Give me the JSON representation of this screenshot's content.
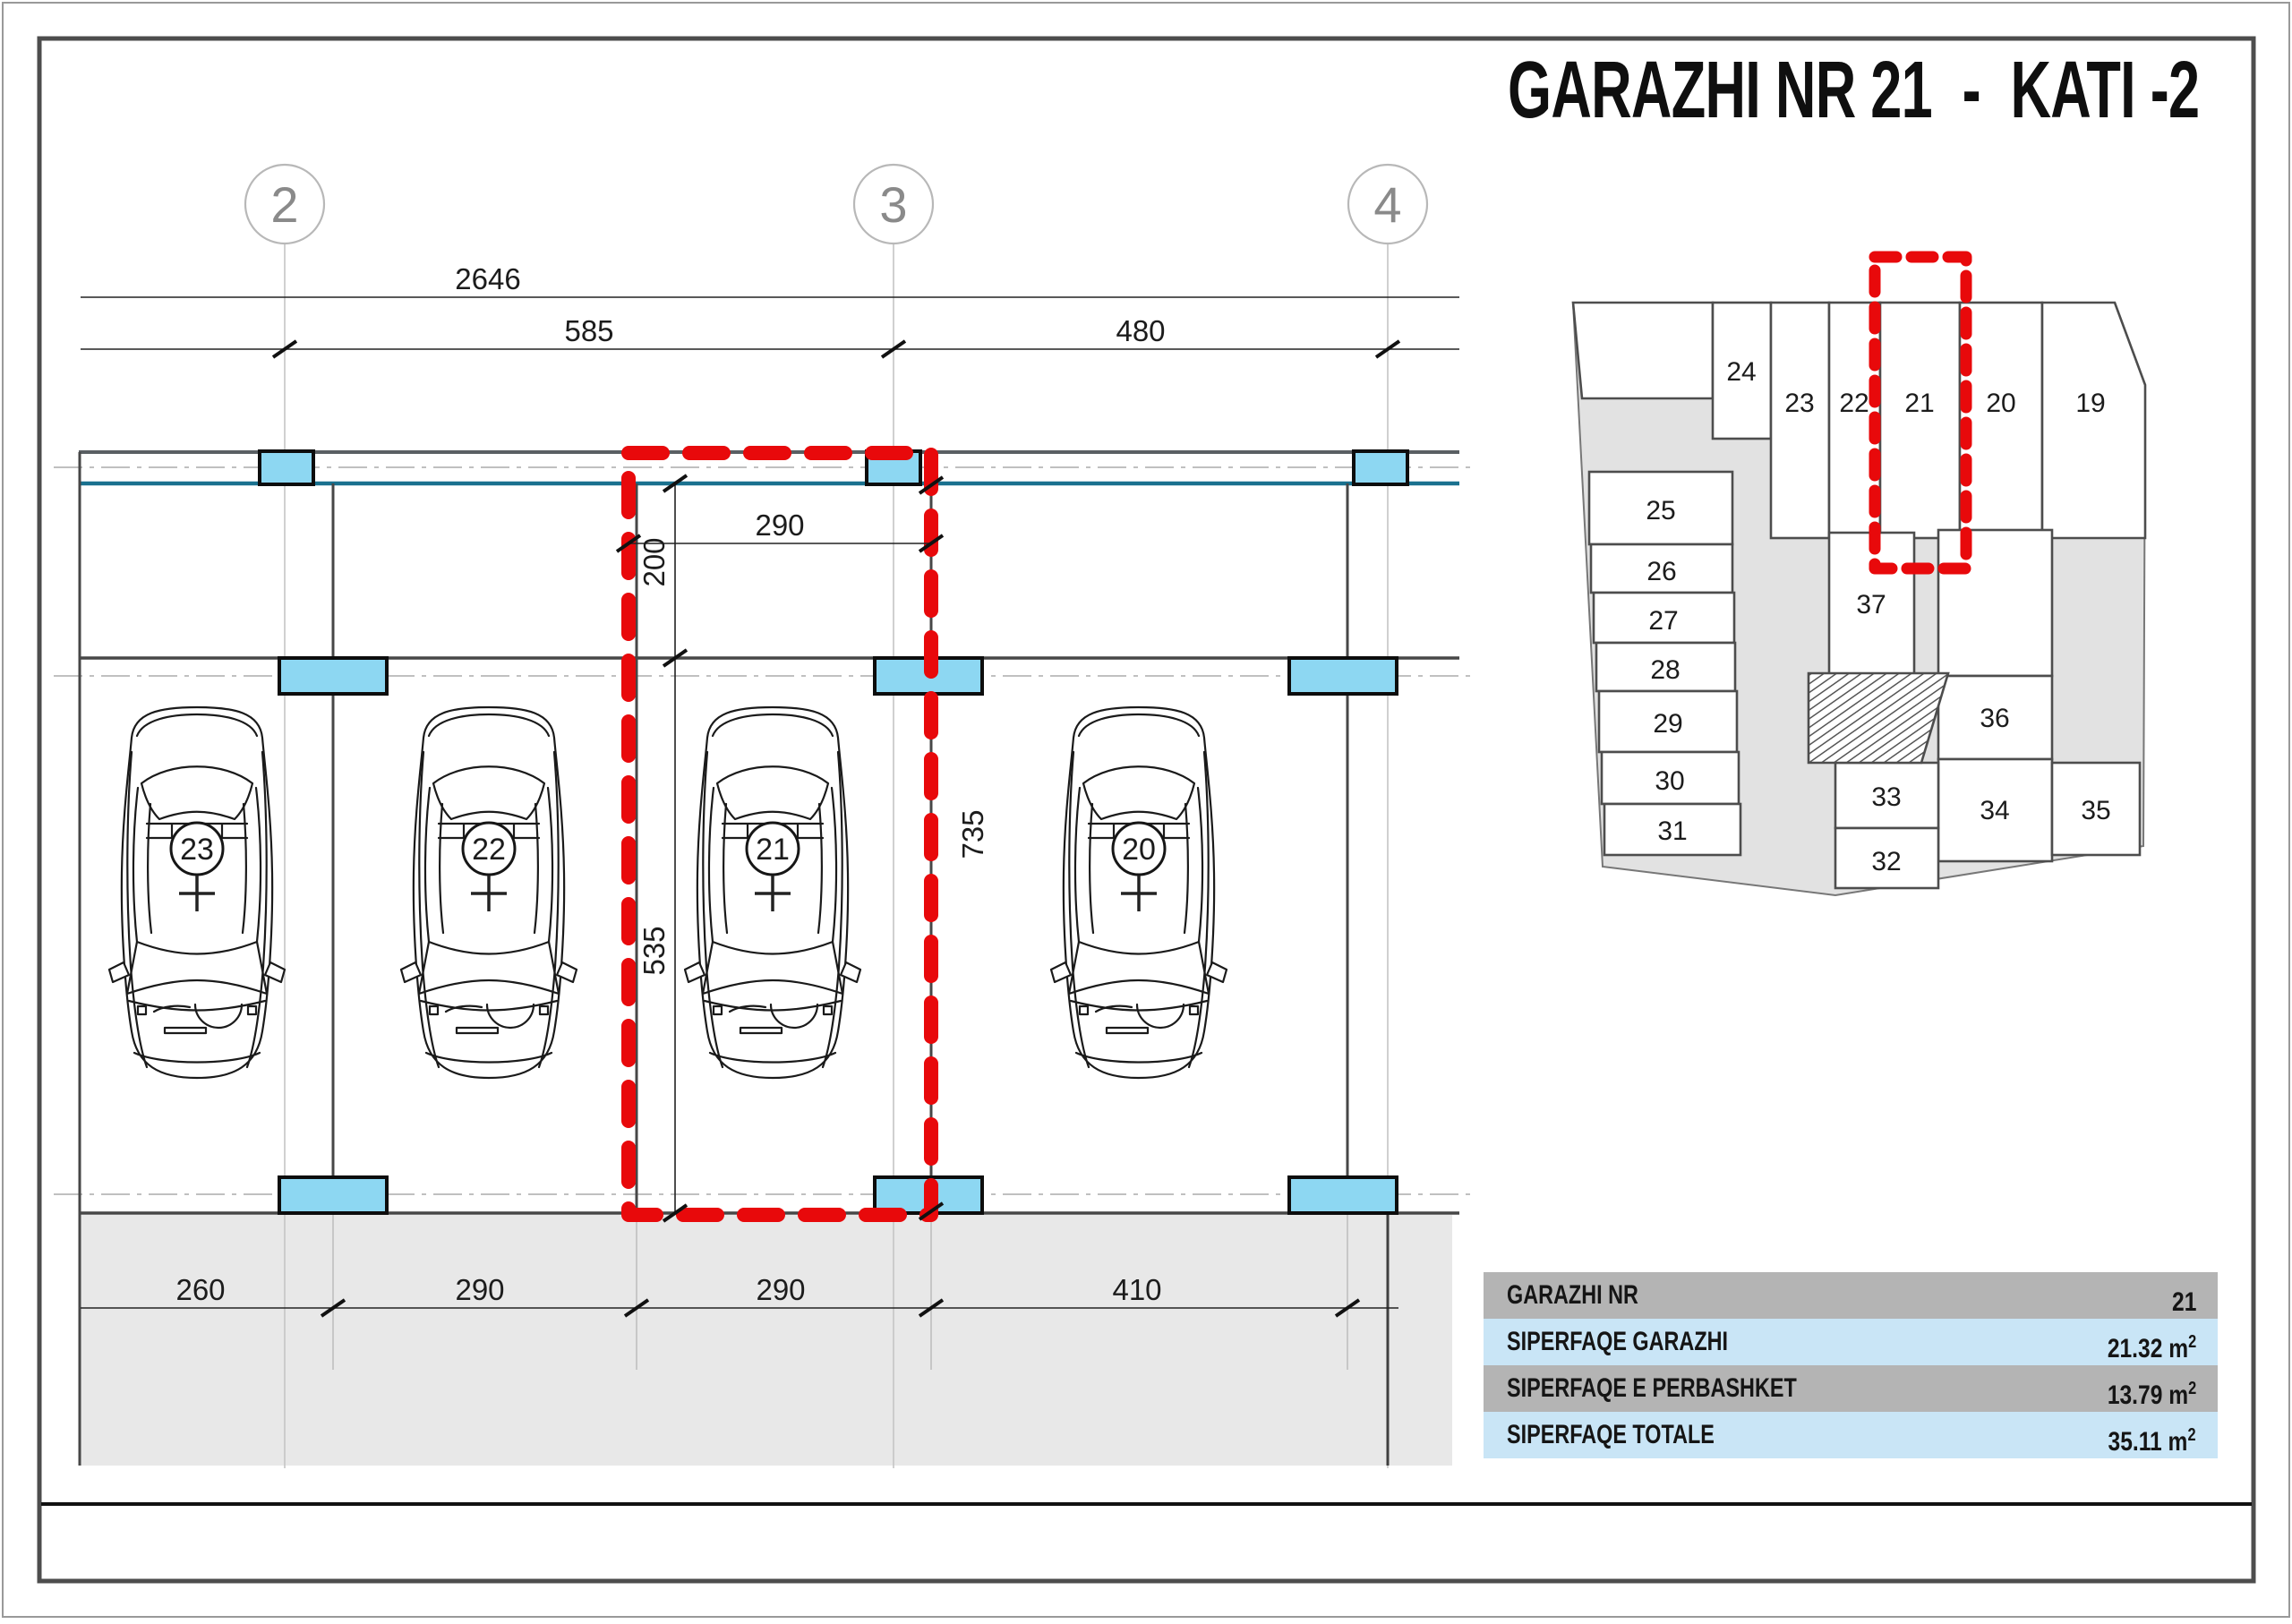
{
  "title": {
    "text": "GARAZHI NR 21  -  KATI -2"
  },
  "colors": {
    "accent_red": "#E8090B",
    "column_fill": "#8DD7F2",
    "wall_teal": "#19718F",
    "wall_slate": "#5A5F63",
    "driveway_gray": "#E8E8E8",
    "minimap_gray": "#E2E2E2",
    "table_row_gray": "#B4B4B4",
    "table_row_blue": "#C9E5F6"
  },
  "plan": {
    "grid_bubbles": [
      "2",
      "3",
      "4"
    ],
    "dims": {
      "overall": "2646",
      "left_span": "585",
      "right_span": "480",
      "garage_width": "290",
      "depth_upper": "200",
      "depth_lower": "535",
      "depth_total": "735",
      "bottom": [
        "260",
        "290",
        "290",
        "410"
      ]
    },
    "spaces": {
      "s23": "23",
      "s22": "22",
      "s21": "21",
      "s20": "20"
    }
  },
  "minimap": {
    "cells": {
      "c24": "24",
      "c23": "23",
      "c22": "22",
      "c21": "21",
      "c20": "20",
      "c19": "19",
      "c25": "25",
      "c26": "26",
      "c27": "27",
      "c28": "28",
      "c29": "29",
      "c30": "30",
      "c31": "31",
      "c37": "37",
      "c36": "36",
      "c33": "33",
      "c32": "32",
      "c34": "34",
      "c35": "35"
    },
    "highlighted_cell": "21"
  },
  "table": {
    "rows": [
      {
        "label": "GARAZHI NR",
        "value": "21",
        "unit_base": "",
        "unit_sup": ""
      },
      {
        "label": "SIPERFAQE GARAZHI",
        "value": "21.32",
        "unit_base": " m",
        "unit_sup": "2"
      },
      {
        "label": "SIPERFAQE E PERBASHKET",
        "value": "13.79",
        "unit_base": " m",
        "unit_sup": "2"
      },
      {
        "label": "SIPERFAQE TOTALE",
        "value": "35.11",
        "unit_base": " m",
        "unit_sup": "2"
      }
    ]
  }
}
